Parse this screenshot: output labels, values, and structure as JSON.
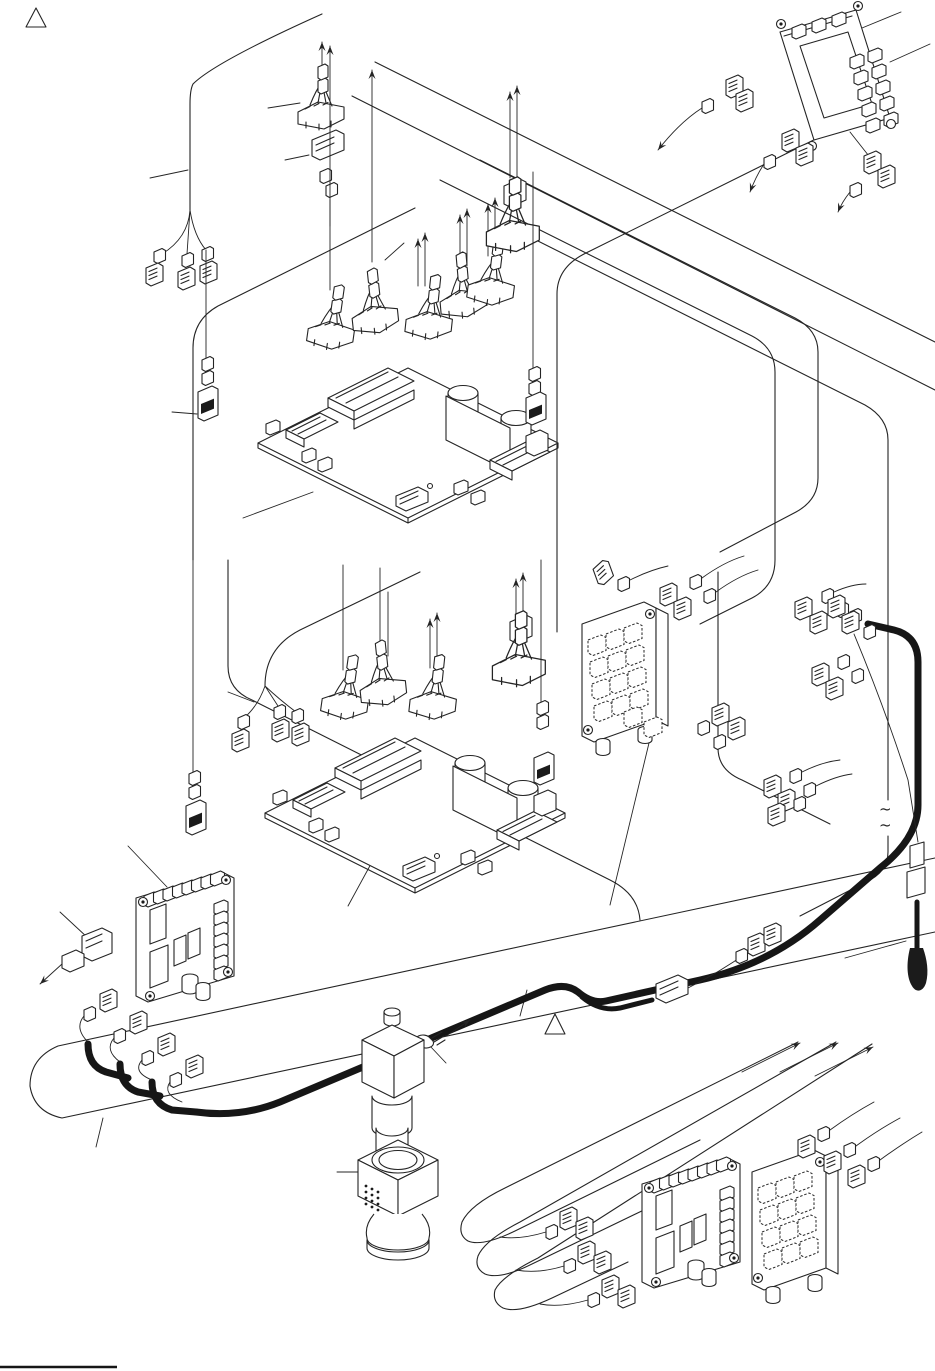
{
  "document": {
    "kind": "exploded wiring / harness routing diagram (service manual page)",
    "background_color": "#ffffff",
    "ink_color": "#242424",
    "harness_color": "#161616"
  },
  "symbols": {
    "warning_triangle": "△",
    "cable_break_mark": "~"
  },
  "depicted_parts": [
    "warning-triangle-top-left",
    "warning-triangle-center",
    "main-pcb-upper",
    "main-pcb-lower",
    "io-pcb-top-right",
    "relay-pcb-middle-right",
    "driver-pcb-bottom-left",
    "driver-pcb-bottom-right",
    "relay-pcb-bottom-right",
    "main-wire-harness",
    "inline-connector",
    "molded-plug",
    "solenoid",
    "lamp-unit",
    "mounting-screw",
    "cable-assemblies-with-direction-arrows",
    "routing-loom-outlines",
    "page-footer-rule"
  ]
}
